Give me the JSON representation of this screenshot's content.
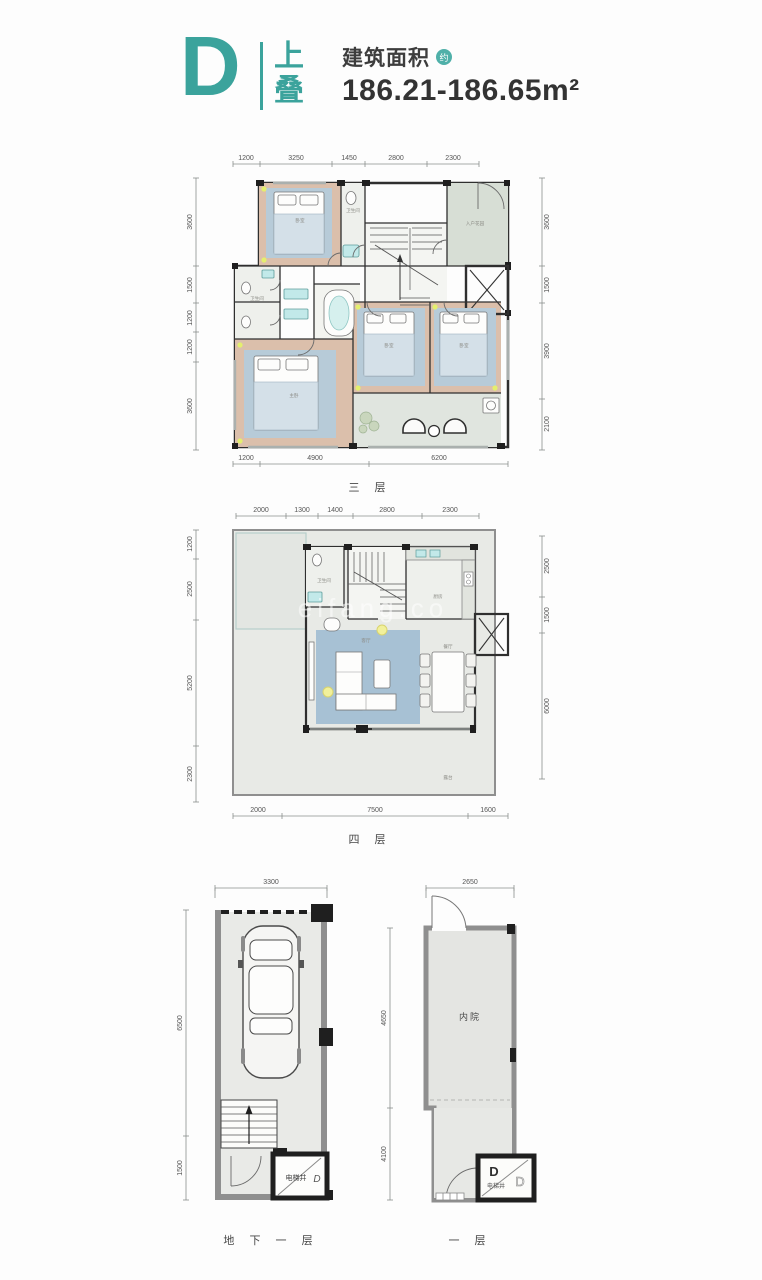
{
  "header": {
    "unit_letter": "D",
    "stack_label": [
      "上",
      "叠"
    ],
    "area_label": "建筑面积",
    "area_approx_badge": "约",
    "area_value": "186.21-186.65m²"
  },
  "watermark": "eifang.co",
  "colors": {
    "accent_teal": "#3BA39C",
    "wall_dark": "#2f2f2f",
    "wall_gray": "#8f8f8f",
    "floor_wood": "#dbbfab",
    "floor_green": "#ccd5cc",
    "rug_blue": "#a7c1d4",
    "light_yellow": "#e4ef6e"
  },
  "plans": {
    "floor3": {
      "caption": "三 层",
      "dims_top": [
        "1200",
        "3250",
        "1450",
        "2800",
        "2300"
      ],
      "dims_bottom": [
        "1200",
        "4900",
        "6200"
      ],
      "dims_left": [
        "3600",
        "1500",
        "1200",
        "1200",
        "3600"
      ],
      "dims_right": [
        "3600",
        "1500",
        "3900",
        "2100"
      ],
      "labels": {
        "bedroom1": "卧室",
        "bath1": "卫生间",
        "bath2": "卫生间",
        "foyer": "入户花园",
        "master": "主卧",
        "bedroom2": "卧室",
        "bedroom3": "卧室"
      }
    },
    "floor4": {
      "caption": "四 层",
      "dims_top": [
        "2000",
        "1300",
        "1400",
        "2800",
        "2300"
      ],
      "dims_bottom": [
        "2000",
        "7500",
        "1600"
      ],
      "dims_left": [
        "1200",
        "2500",
        "5200",
        "2300"
      ],
      "dims_right": [
        "2500",
        "1500",
        "6000"
      ],
      "labels": {
        "bath": "卫生间",
        "kitchen": "厨房",
        "living": "客厅",
        "dining": "餐厅",
        "terrace": "露台"
      }
    },
    "basement": {
      "caption": "地 下 一 层",
      "dims_top": [
        "3300"
      ],
      "dims_left": [
        "6500",
        "1500"
      ],
      "labels": {
        "elevator": "电梯井",
        "unit": "D"
      }
    },
    "floor1": {
      "caption": "一 层",
      "dims_top": [
        "2650"
      ],
      "dims_left": [
        "4650",
        "4100"
      ],
      "labels": {
        "courtyard": "内院",
        "elevator": "电梯井",
        "unit_d1": "D",
        "unit_d2": "D"
      }
    }
  }
}
